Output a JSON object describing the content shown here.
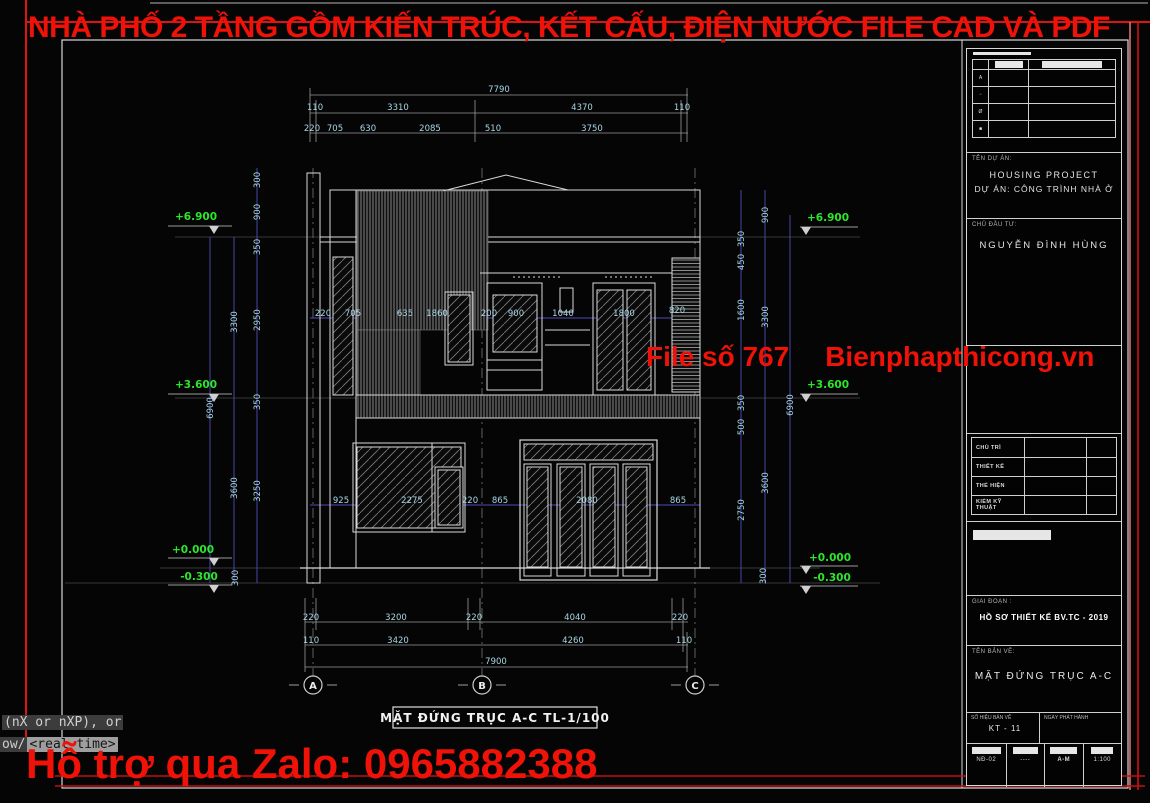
{
  "banners": {
    "top": "NHÀ PHỐ 2 TẦNG GỒM KIẾN TRÚC, KẾT CẤU, ĐIỆN NƯỚC FILE CAD VÀ PDF",
    "watermark_left": "File số 767",
    "watermark_right": "Bienphapthicong.vn",
    "zalo": "Hỗ trợ qua Zalo: 0965882388",
    "accent_red": "#ee1208",
    "level_green": "#2ce62c",
    "dim_cyan": "#a9d6e6"
  },
  "command_line": {
    "line1": "(nX or nXP), or",
    "line2_prefix": "ow/",
    "line2_default": "<real time>"
  },
  "drawing": {
    "label": "MẶT ĐỨNG TRỤC A-C TL-1/100",
    "axes": [
      {
        "t": "A",
        "x": 313,
        "y": 689
      },
      {
        "t": "B",
        "x": 482,
        "y": 689
      },
      {
        "t": "C",
        "x": 695,
        "y": 689
      }
    ],
    "levels": [
      {
        "t": "+6.900",
        "x": 196,
        "y": 220
      },
      {
        "t": "+3.600",
        "x": 196,
        "y": 388
      },
      {
        "t": "+0.000",
        "x": 193,
        "y": 553
      },
      {
        "t": "-0.300",
        "x": 199,
        "y": 580
      },
      {
        "t": "+6.900",
        "x": 828,
        "y": 221
      },
      {
        "t": "+3.600",
        "x": 828,
        "y": 388
      },
      {
        "t": "+0.000",
        "x": 830,
        "y": 561
      },
      {
        "t": "-0.300",
        "x": 832,
        "y": 581
      }
    ],
    "dims": [
      {
        "t": "7790",
        "x": 499,
        "y": 92
      },
      {
        "t": "110",
        "x": 315,
        "y": 110
      },
      {
        "t": "3310",
        "x": 398,
        "y": 110
      },
      {
        "t": "4370",
        "x": 582,
        "y": 110
      },
      {
        "t": "110",
        "x": 682,
        "y": 110
      },
      {
        "t": "220",
        "x": 312,
        "y": 131
      },
      {
        "t": "705",
        "x": 335,
        "y": 131
      },
      {
        "t": "630",
        "x": 368,
        "y": 131
      },
      {
        "t": "2085",
        "x": 430,
        "y": 131
      },
      {
        "t": "510",
        "x": 493,
        "y": 131
      },
      {
        "t": "3750",
        "x": 592,
        "y": 131
      },
      {
        "t": "220",
        "x": 323,
        "y": 316
      },
      {
        "t": "705",
        "x": 353,
        "y": 316
      },
      {
        "t": "635",
        "x": 405,
        "y": 316
      },
      {
        "t": "1860",
        "x": 437,
        "y": 316
      },
      {
        "t": "200",
        "x": 489,
        "y": 316
      },
      {
        "t": "900",
        "x": 516,
        "y": 316
      },
      {
        "t": "1040",
        "x": 563,
        "y": 316
      },
      {
        "t": "1800",
        "x": 624,
        "y": 316
      },
      {
        "t": "820",
        "x": 677,
        "y": 313
      },
      {
        "t": "925",
        "x": 341,
        "y": 503
      },
      {
        "t": "2275",
        "x": 412,
        "y": 503
      },
      {
        "t": "220",
        "x": 470,
        "y": 503
      },
      {
        "t": "865",
        "x": 500,
        "y": 503
      },
      {
        "t": "2080",
        "x": 587,
        "y": 503
      },
      {
        "t": "865",
        "x": 678,
        "y": 503
      },
      {
        "t": "220",
        "x": 311,
        "y": 620
      },
      {
        "t": "3200",
        "x": 396,
        "y": 620
      },
      {
        "t": "220",
        "x": 474,
        "y": 620
      },
      {
        "t": "4040",
        "x": 575,
        "y": 620
      },
      {
        "t": "220",
        "x": 680,
        "y": 620
      },
      {
        "t": "110",
        "x": 311,
        "y": 643
      },
      {
        "t": "3420",
        "x": 398,
        "y": 643
      },
      {
        "t": "4260",
        "x": 573,
        "y": 643
      },
      {
        "t": "110",
        "x": 684,
        "y": 643
      },
      {
        "t": "7900",
        "x": 496,
        "y": 664
      },
      {
        "t": "300",
        "x": 260,
        "y": 180,
        "r": 1
      },
      {
        "t": "900",
        "x": 260,
        "y": 212,
        "r": 1
      },
      {
        "t": "350",
        "x": 260,
        "y": 247,
        "r": 1
      },
      {
        "t": "2950",
        "x": 260,
        "y": 320,
        "r": 1
      },
      {
        "t": "350",
        "x": 260,
        "y": 402,
        "r": 1
      },
      {
        "t": "3250",
        "x": 260,
        "y": 491,
        "r": 1
      },
      {
        "t": "3300",
        "x": 237,
        "y": 322,
        "r": 1
      },
      {
        "t": "3600",
        "x": 237,
        "y": 488,
        "r": 1
      },
      {
        "t": "6900",
        "x": 213,
        "y": 408,
        "r": 1
      },
      {
        "t": "300",
        "x": 238,
        "y": 578,
        "r": 1
      },
      {
        "t": "900",
        "x": 768,
        "y": 215,
        "r": 1
      },
      {
        "t": "350",
        "x": 744,
        "y": 239,
        "r": 1
      },
      {
        "t": "450",
        "x": 744,
        "y": 262,
        "r": 1
      },
      {
        "t": "1600",
        "x": 744,
        "y": 310,
        "r": 1
      },
      {
        "t": "3300",
        "x": 768,
        "y": 317,
        "r": 1
      },
      {
        "t": "350",
        "x": 744,
        "y": 403,
        "r": 1
      },
      {
        "t": "500",
        "x": 744,
        "y": 427,
        "r": 1
      },
      {
        "t": "2750",
        "x": 744,
        "y": 510,
        "r": 1
      },
      {
        "t": "3600",
        "x": 768,
        "y": 483,
        "r": 1
      },
      {
        "t": "6900",
        "x": 793,
        "y": 405,
        "r": 1
      },
      {
        "t": "300",
        "x": 766,
        "y": 576,
        "r": 1
      }
    ]
  },
  "titleblock": {
    "project_label": "TÊN DỰ ÁN:",
    "project_name1": "HOUSING PROJECT",
    "project_name2": "DỰ ÁN: CÔNG TRÌNH NHÀ Ở",
    "owner_label": "CHỦ ĐẦU TƯ:",
    "owner_name": "NGUYỄN ĐÌNH HÙNG",
    "rev_symbols": [
      "A",
      "▫",
      "Ø",
      "■",
      "▪"
    ],
    "sign_rows": [
      "CHỦ TRÌ",
      "THIẾT KẾ",
      "THỂ HIỆN",
      "KIỂM KỸ THUẬT"
    ],
    "stage_label": "GIAI ĐOẠN :",
    "stage_value": "HỒ SƠ THIẾT KẾ BV.TC - 2019",
    "sheet_label": "TÊN BẢN VẼ:",
    "sheet_name": "MẶT ĐỨNG TRỤC A-C",
    "no_label": "SỐ HIỆU BẢN VẼ",
    "no_value": "KT - 11",
    "date_label": "NGÀY PHÁT HÀNH",
    "footer_values": [
      "NĐ-02",
      "----",
      "A-M",
      "1:100"
    ]
  }
}
